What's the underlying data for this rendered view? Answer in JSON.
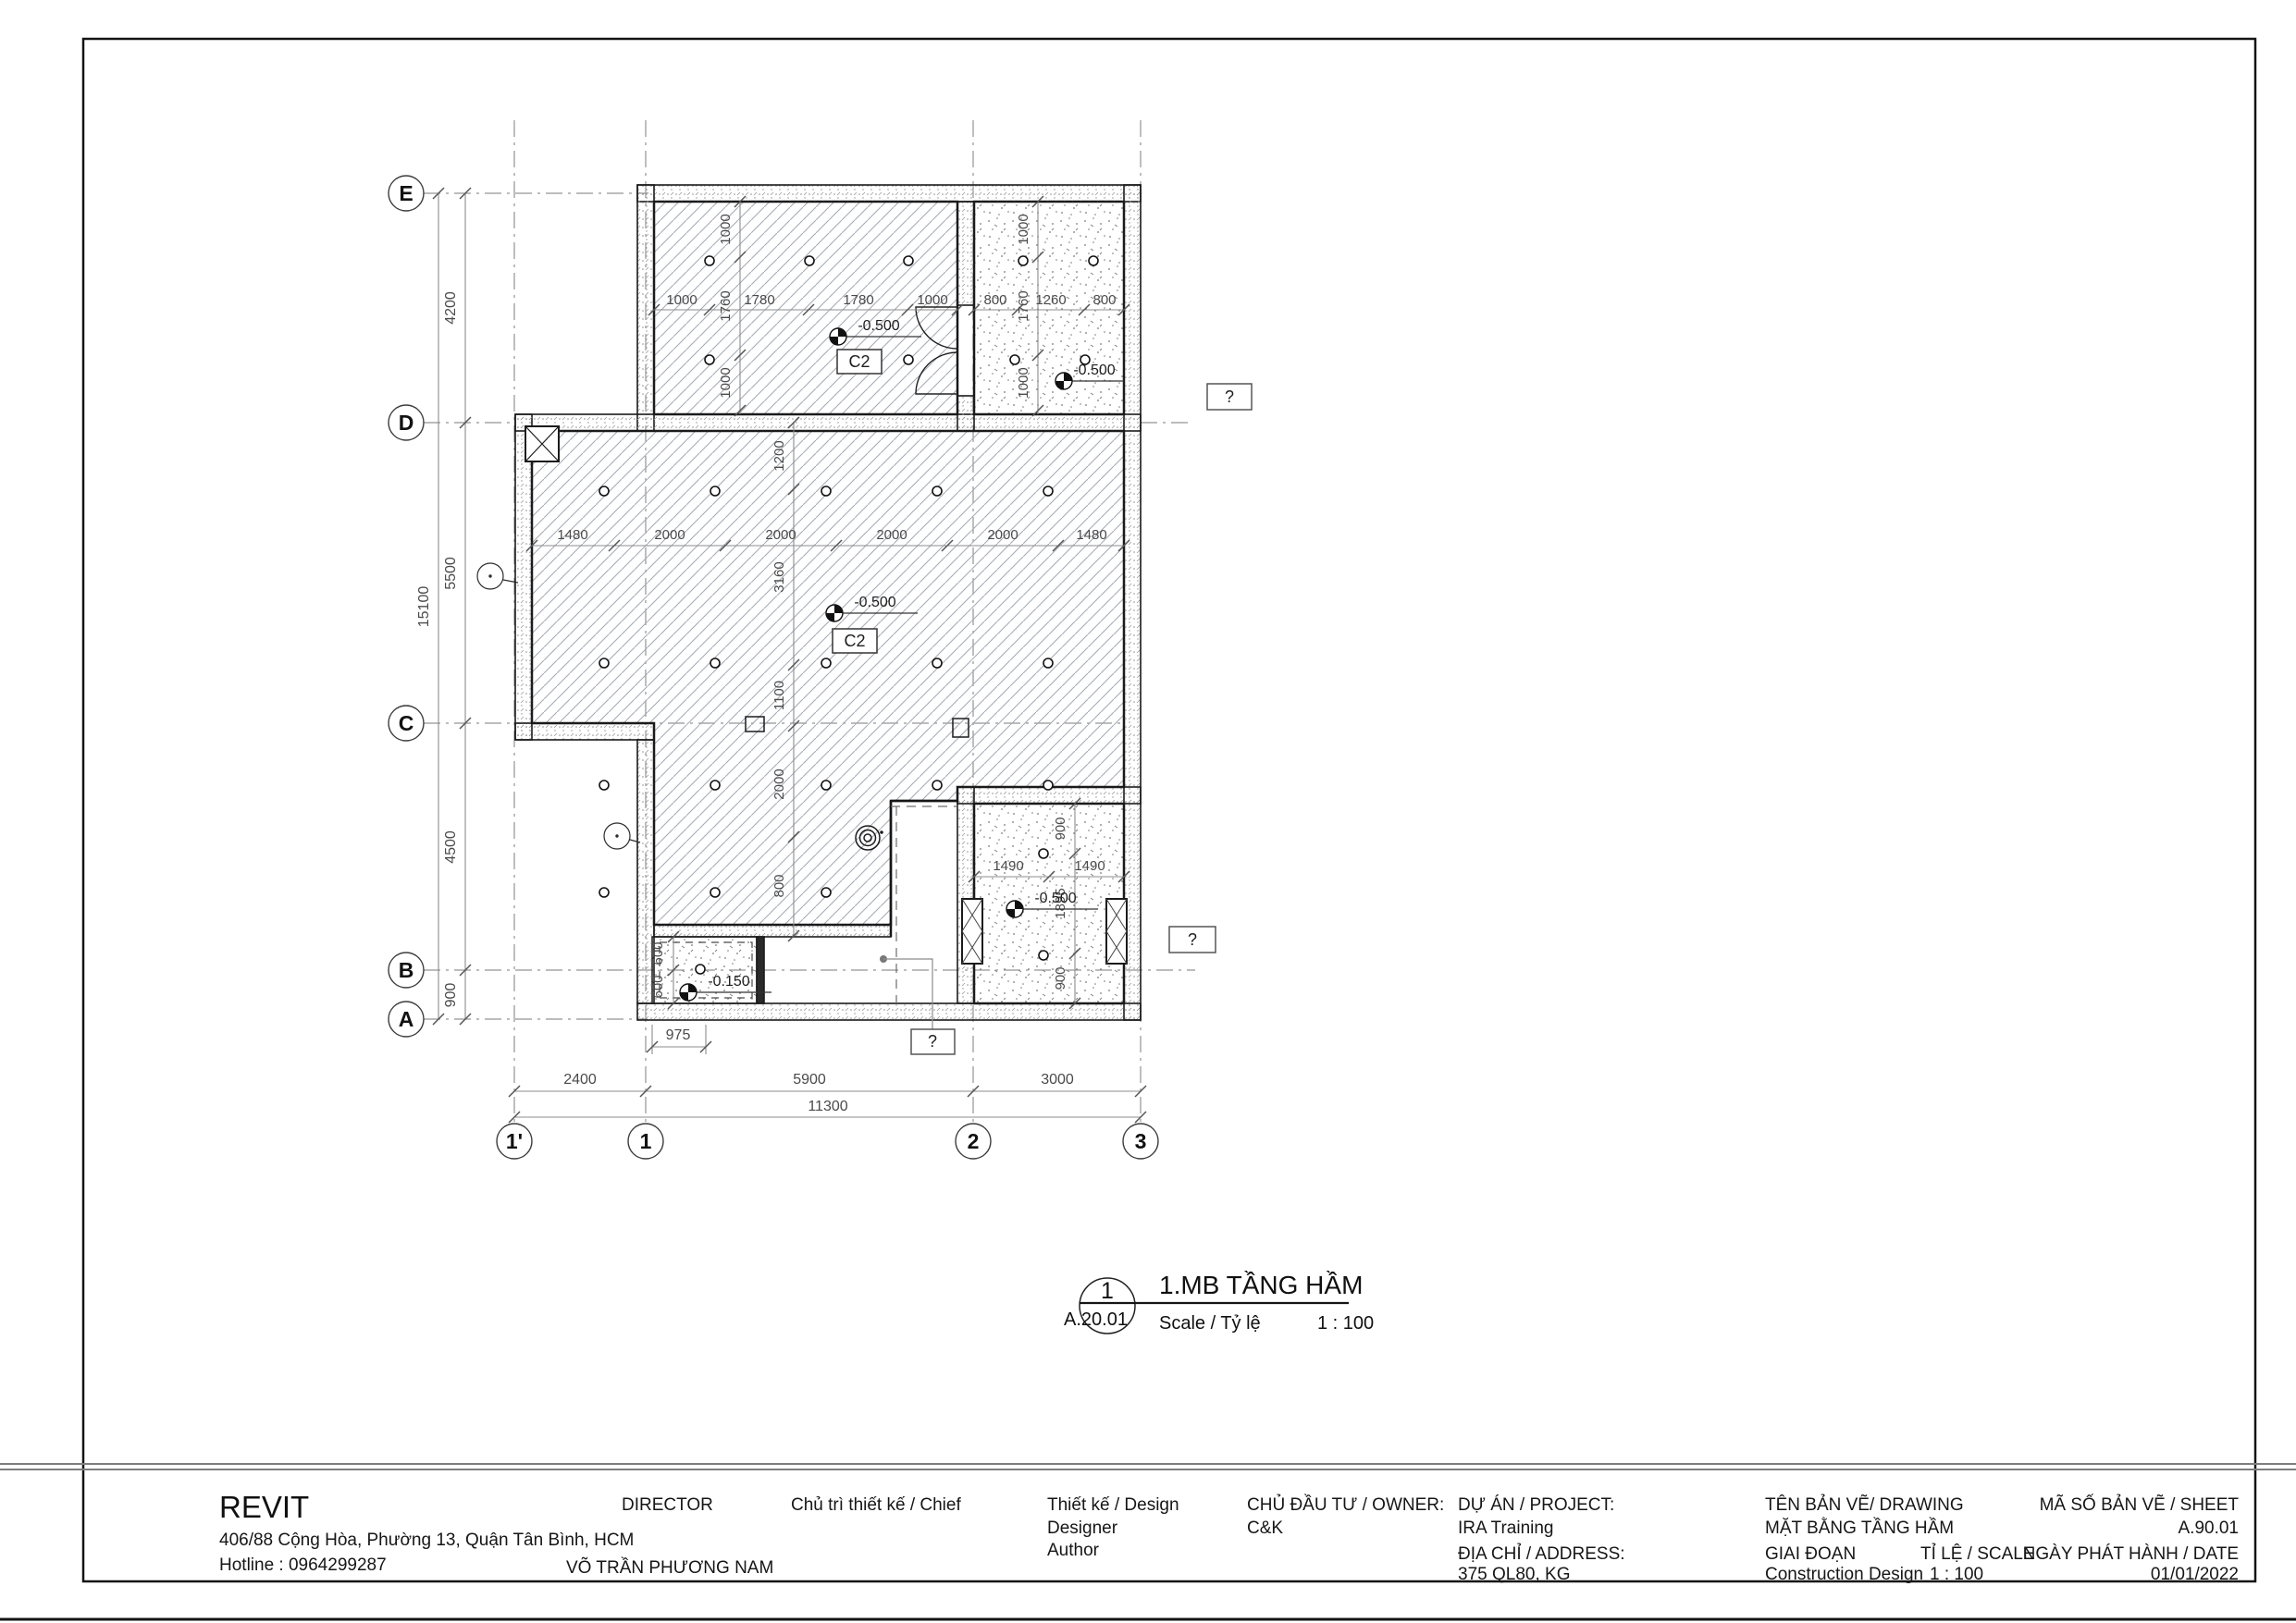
{
  "view_title": {
    "number": "1",
    "sheet_ref": "A.20.01",
    "title": "1.MB TẦNG HẦM",
    "scale_label": "Scale / Tỷ lệ",
    "scale_value": "1 : 100"
  },
  "title_block": {
    "company": "REVIT",
    "company_address": "406/88 Cộng Hòa, Phường 13, Quận Tân Bình, HCM",
    "hotline": "Hotline : 0964299287",
    "director_label": "DIRECTOR",
    "chief_label": "Chủ trì thiết kế / Chief",
    "chief_name": "VÕ TRẦN PHƯƠNG NAM",
    "design_label": "Thiết kế / Design",
    "designer_label": "Designer",
    "author_label": "Author",
    "owner_label": "CHỦ ĐẦU TƯ / OWNER:",
    "owner_name": "C&K",
    "project_label": "DỰ ÁN / PROJECT:",
    "project_name": "IRA Training",
    "address_label": "ĐỊA CHỈ / ADDRESS:",
    "address_value": "375 QL80, KG",
    "drawing_label": "TÊN BẢN VẼ/ DRAWING",
    "drawing_name": "MẶT BẰNG TẦNG HẦM",
    "sheet_label": "MÃ SỐ BẢN VẼ / SHEET",
    "sheet_number": "A.90.01",
    "phase_label": "GIAI ĐOẠN",
    "phase_value": "Construction Design",
    "scale_label": "TỈ LỆ / SCALE",
    "scale_value": "1 : 100",
    "date_label": "NGÀY PHÁT HÀNH / DATE",
    "date_value": "01/01/2022"
  },
  "grids": {
    "rows": [
      "E",
      "D",
      "C",
      "B",
      "A"
    ],
    "cols": [
      "1'",
      "1",
      "2",
      "3"
    ]
  },
  "dims": {
    "left_overall": "15100",
    "left": [
      "4200",
      "5500",
      "4500",
      "900"
    ],
    "bottom": [
      "2400",
      "5900",
      "3000"
    ],
    "bottom_overall": "11300",
    "bottom_small": "975",
    "room_tl_h": [
      "1000",
      "1780",
      "1780",
      "1000"
    ],
    "room_tl_v": [
      "1000",
      "1760",
      "1000"
    ],
    "room_tr_h": [
      "800",
      "1260",
      "800"
    ],
    "room_tr_v": [
      "1000",
      "1760",
      "1000"
    ],
    "hall_h": [
      "1480",
      "2000",
      "2000",
      "2000",
      "2000",
      "1480"
    ],
    "hall_v": [
      "1200",
      "3160",
      "1100",
      "2000",
      "800"
    ],
    "room_br_h": [
      "1490",
      "1490"
    ],
    "room_br_v": [
      "900",
      "1895",
      "900"
    ],
    "pit_v": [
      "600",
      "600"
    ]
  },
  "levels": {
    "tl": "-0.500",
    "tr": "-0.500",
    "hall": "-0.500",
    "br": "-0.500",
    "pit": "-0.150"
  },
  "tags": {
    "column_tag": "C2",
    "unknown_tag": "?"
  }
}
